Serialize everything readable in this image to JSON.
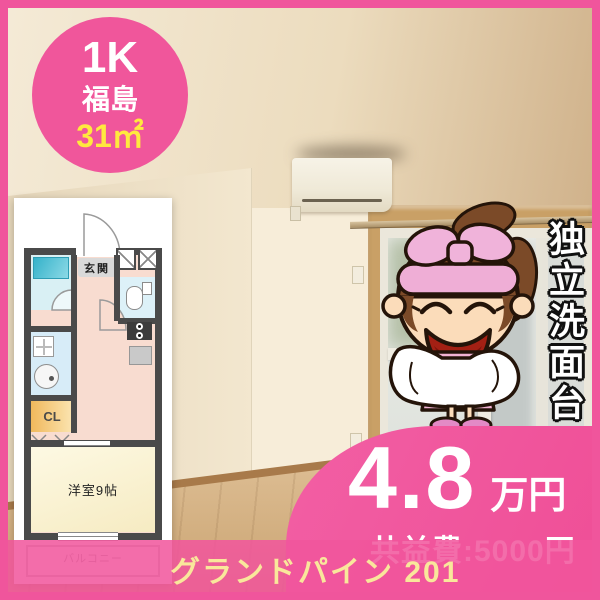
{
  "colors": {
    "accent_pink": "#f0559c",
    "badge_size_yellow": "#ffe93e",
    "property_name_yellow": "#f9e79b",
    "plan_wall_gray": "#4a4a4a"
  },
  "badge": {
    "layout": "1K",
    "area": "福島",
    "size": "31㎡"
  },
  "floorplan": {
    "entrance": "玄関",
    "closet": "CL",
    "room": "洋室9帖",
    "balcony": "バルコニー"
  },
  "feature": {
    "vertical_text": "独立洗面台"
  },
  "price": {
    "amount": "4.8",
    "unit": "万円",
    "fee": "共益費:5000円"
  },
  "property": {
    "name": "グランドパイン 201"
  },
  "icons": {
    "mascot": "cleaning-girl-mascot",
    "ac": "air-conditioner",
    "toilet": "toilet-icon",
    "bathtub": "bathtub-icon",
    "washer": "washing-machine-icon",
    "sink": "sink-icon"
  }
}
